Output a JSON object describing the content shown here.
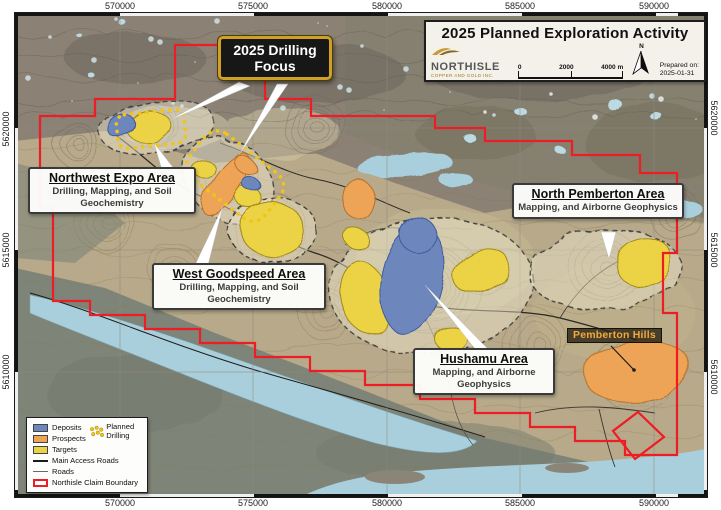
{
  "frame": {
    "coords_top": [
      "570000",
      "575000",
      "580000",
      "585000",
      "590000"
    ],
    "coords_bottom": [
      "570000",
      "575000",
      "580000",
      "585000",
      "590000"
    ],
    "coords_left": [
      "5620000",
      "5615000",
      "5610000"
    ],
    "coords_right": [
      "5620000",
      "5615000",
      "5610000"
    ]
  },
  "title_box": {
    "title": "2025 Planned Exploration Activity",
    "company_name": "NORTHISLE",
    "company_subtitle": "COPPER AND GOLD INC.",
    "scale_ticks": [
      "0",
      "2000",
      "4000 m"
    ],
    "north_label": "N",
    "prepared_label": "Prepared on:",
    "prepared_date": "2025-01-31"
  },
  "callouts": {
    "drilling_focus": "2025 Drilling Focus",
    "areas": [
      {
        "name": "Northwest Expo Area",
        "activities": "Drilling, Mapping, and Soil Geochemistry"
      },
      {
        "name": "West Goodspeed Area",
        "activities": "Drilling, Mapping, and Soil Geochemistry"
      },
      {
        "name": "North Pemberton Area",
        "activities": "Mapping, and Airborne Geophysics"
      },
      {
        "name": "Hushamu Area",
        "activities": "Mapping, and Airborne Geophysics"
      }
    ],
    "place_label": "Pemberton Hills"
  },
  "legend": {
    "deposits": "Deposits",
    "prospects": "Prospects",
    "targets": "Targets",
    "planned_drilling": "Planned Drilling",
    "main_access_roads": "Main Access Roads",
    "roads": "Roads",
    "claim_boundary": "Northisle Claim Boundary"
  },
  "colors": {
    "deposit": "#6d87bd",
    "prospect": "#eea457",
    "target": "#ecd245",
    "planned_drilling_dot": "#f2c514",
    "claim_boundary": "#ee1c25",
    "water": "#aacfdc"
  }
}
